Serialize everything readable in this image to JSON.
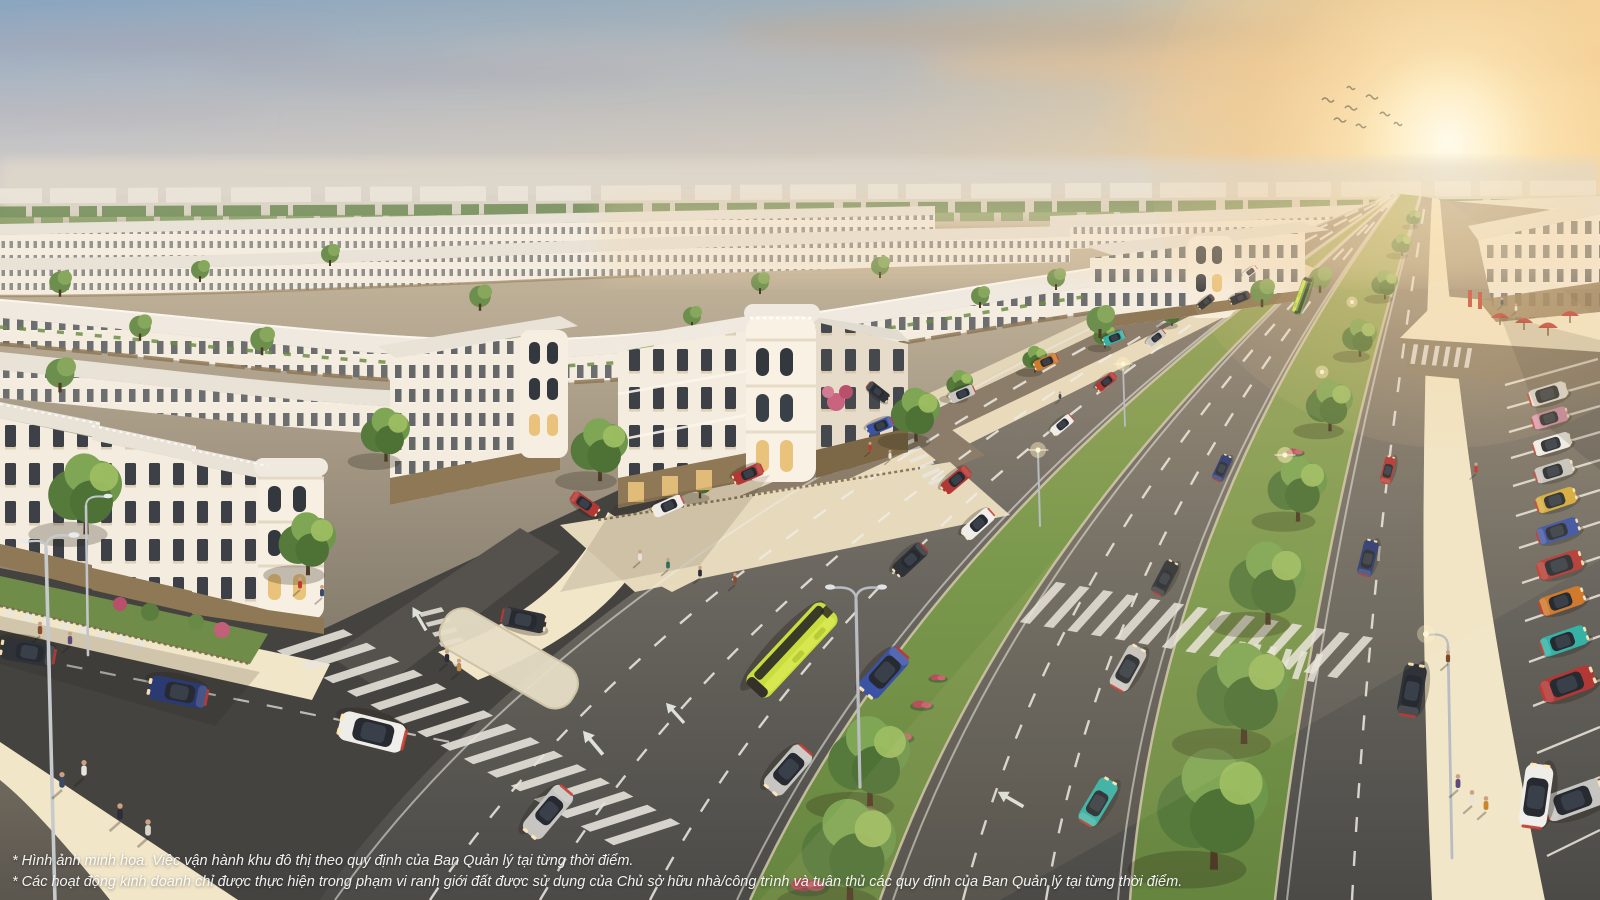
{
  "scene": {
    "description": "Aerial sunset render of a planned urban area: curved rows of white neoclassical shophouses, a wide tree-lined boulevard with traffic and a yellow-green bus, landscaped flower medians, zebra crossings, pedestrians, and angled parking with colorful cars on the right.",
    "disclaimer_line1": "* Hình ảnh minh họa. Việc vận hành khu đô thị theo quy định của Ban Quản lý tại từng thời điểm.",
    "disclaimer_line2": "* Các hoạt động kinh doanh chỉ được thực hiện trong phạm vi ranh giới đất được sử dụng của Chủ sở hữu nhà/công trình và tuân thủ các quy định của Ban Quản lý tại từng thời điểm."
  },
  "palette": {
    "skyTop": "#8aa5c0",
    "skyMid": "#c3c2c5",
    "skyLow": "#ded4c8",
    "sunCore": "#fffdf4",
    "sunGlow": "#f8cf92",
    "cloudGrey": "#a79fab",
    "cloudWarm": "#eec08d",
    "hazeBand": "#ded7cb",
    "distantFacade": "#ebe5da",
    "distantTree": "#6d8a52",
    "roofLight": "#efe9e0",
    "roofPale": "#e8e2d7",
    "facadeLit": "#f4ecdf",
    "facadeShade": "#e7dcc9",
    "windowDark": "#383d44",
    "bronze": "#8f7856",
    "bronzeDark": "#7c6847",
    "shopGlow": "#ecc47f",
    "grass": "#7c9a4d",
    "grassDeep": "#5f7f3c",
    "flowerRed": "#bb4f5c",
    "treeDark": "#55793c",
    "treeMid": "#6f974c",
    "treeLight": "#9dbd62",
    "trunk": "#4e3b26",
    "asphalt": "#55524d",
    "asphaltDark": "#454340",
    "asphaltWarm": "#8b7d6a",
    "laneWhite": "#efece4",
    "sidewalk": "#e7d9bc",
    "sidewalkBright": "#f2e6c9",
    "curb": "#d9cdb1",
    "carRed": "#b23835",
    "carBlue": "#3b53a4",
    "carNavy": "#2c3a72",
    "carTeal": "#35b1a6",
    "carSilver": "#c7c5c1",
    "carWhite": "#efede8",
    "carDark": "#2f3237",
    "carOrange": "#cf7a2d",
    "carYellow": "#d6ac3c",
    "carPink": "#d791ae",
    "busYellow": "#c9dd3e",
    "busDark": "#30302a"
  }
}
